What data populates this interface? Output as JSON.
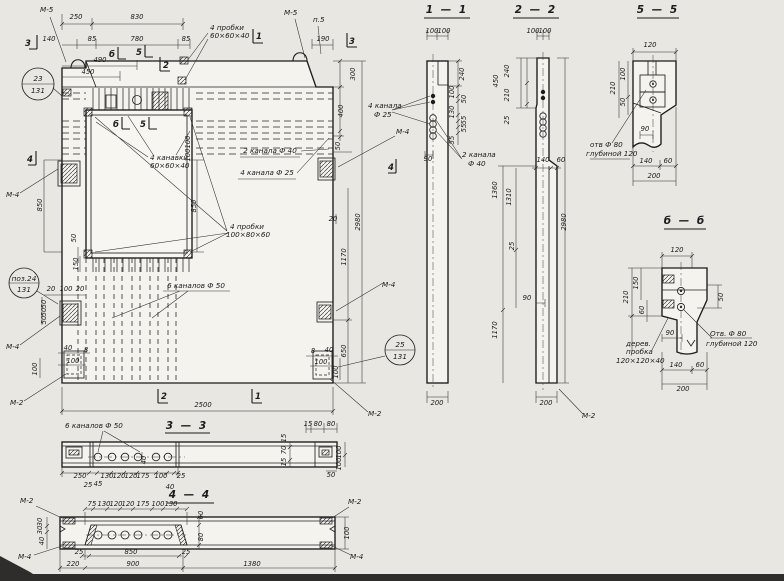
{
  "colors": {
    "paper": "#e9e7e1",
    "ink": "#1b1b1b",
    "panel_fill": "#f4f3ee"
  },
  "main": {
    "labels": {
      "m5_left": "М-5",
      "m5_top": "М-5",
      "p5": "п.5",
      "plugs_top": [
        "4 пробки",
        "60×60×40"
      ],
      "grooves": [
        "4 канавки",
        "60×60×40"
      ],
      "plugs_left": [
        "4 пробки",
        "100×80×60"
      ],
      "ch40": "2 канала Ф 40",
      "ch25": "4 канала Ф 25",
      "ch50": "6 каналов Ф 50",
      "m4": [
        "М-4",
        "М-4",
        "М-4",
        "М-4"
      ],
      "m2": [
        "М-2",
        "М-2"
      ]
    },
    "cuts": {
      "c1": "1",
      "c2": "2",
      "c3": "3",
      "c4": "4",
      "cb": "б",
      "c5": "5"
    },
    "ref_circles": [
      {
        "top": "23",
        "bottom": "131"
      },
      {
        "top": "поз.24",
        "bottom": "131"
      },
      {
        "top": "25",
        "bottom": "131"
      }
    ],
    "dims_top": [
      "250",
      "830",
      "140",
      "85",
      "780",
      "85",
      "490",
      "450",
      "190"
    ],
    "dims_right": [
      "300",
      "400",
      "50",
      "20",
      "2980",
      "1170",
      "650"
    ],
    "dims_left": [
      "850",
      "50",
      "150"
    ],
    "dims_opening": [
      "850",
      "100",
      "100"
    ],
    "embed_left": [
      "20",
      "100",
      "20",
      "50",
      "50",
      "50",
      "40",
      "8",
      "100",
      "100"
    ],
    "embed_right": [
      "8",
      "40",
      "100",
      "100"
    ],
    "dim_bottom": "2500"
  },
  "s11": {
    "title": "1 — 1",
    "dims_top": [
      "100",
      "100"
    ],
    "dims_right": [
      "240",
      "100",
      "50",
      "130",
      "55",
      "55",
      "55"
    ],
    "dim_offset": "90",
    "dim_bottom": "200",
    "ch25": [
      "4 канала",
      "Ф 25"
    ],
    "ch40": [
      "2 канала",
      "Ф 40"
    ]
  },
  "s22": {
    "title": "2 — 2",
    "dims_top": [
      "100",
      "100"
    ],
    "dims_left": [
      "450",
      "240",
      "210",
      "25"
    ],
    "dims_mid": [
      "140",
      "60",
      "1360",
      "1310",
      "25",
      "90",
      "1170"
    ],
    "dim_total": "2980",
    "dim_bottom": "200",
    "m2": "М-2"
  },
  "s55": {
    "title": "5 — 5",
    "dim_width": "120",
    "dims_left": [
      "210",
      "100",
      "50"
    ],
    "dim_offset": "90",
    "dims_bottom": [
      "140",
      "60",
      "200"
    ],
    "hole_label": [
      "отв Ф 80",
      "глубиной 120"
    ]
  },
  "sbb": {
    "title": "б — б",
    "dim_width": "120",
    "dims_left": [
      "210",
      "150",
      "60"
    ],
    "dim_right": "50",
    "dim_offset": "90",
    "dims_bottom": [
      "140",
      "60",
      "200"
    ],
    "hole_label": [
      "Отв. Ф 80",
      "глубиной 120"
    ],
    "plug_label": [
      "дерев.",
      "пробка",
      "120×120×40"
    ]
  },
  "s33": {
    "title": "3 — 3",
    "label": "6 каналов Ф 50",
    "dims_bottom": [
      "250",
      "25",
      "45",
      "130",
      "120",
      "120",
      "175",
      "100",
      "40",
      "25"
    ],
    "dim_inner": "40",
    "dims_right_top": [
      "15",
      "80",
      "80"
    ],
    "dims_right_side": [
      "15",
      "70",
      "15"
    ],
    "dims_far_right": [
      "100",
      "100"
    ],
    "dim_right_bottom": "50"
  },
  "s44": {
    "title": "4 — 4",
    "m2_left": "М-2",
    "m2_right": "М-2",
    "m4_left": "М-4",
    "m4_right": "М-4",
    "dims_top": [
      "75",
      "130",
      "120",
      "120",
      "175",
      "100",
      "130"
    ],
    "dims_left": [
      "30",
      "30",
      "40"
    ],
    "dims_mid": [
      "60",
      "80"
    ],
    "dim_right": "100",
    "dims_bottom": [
      "25",
      "850",
      "25",
      "220",
      "900",
      "1380"
    ]
  }
}
